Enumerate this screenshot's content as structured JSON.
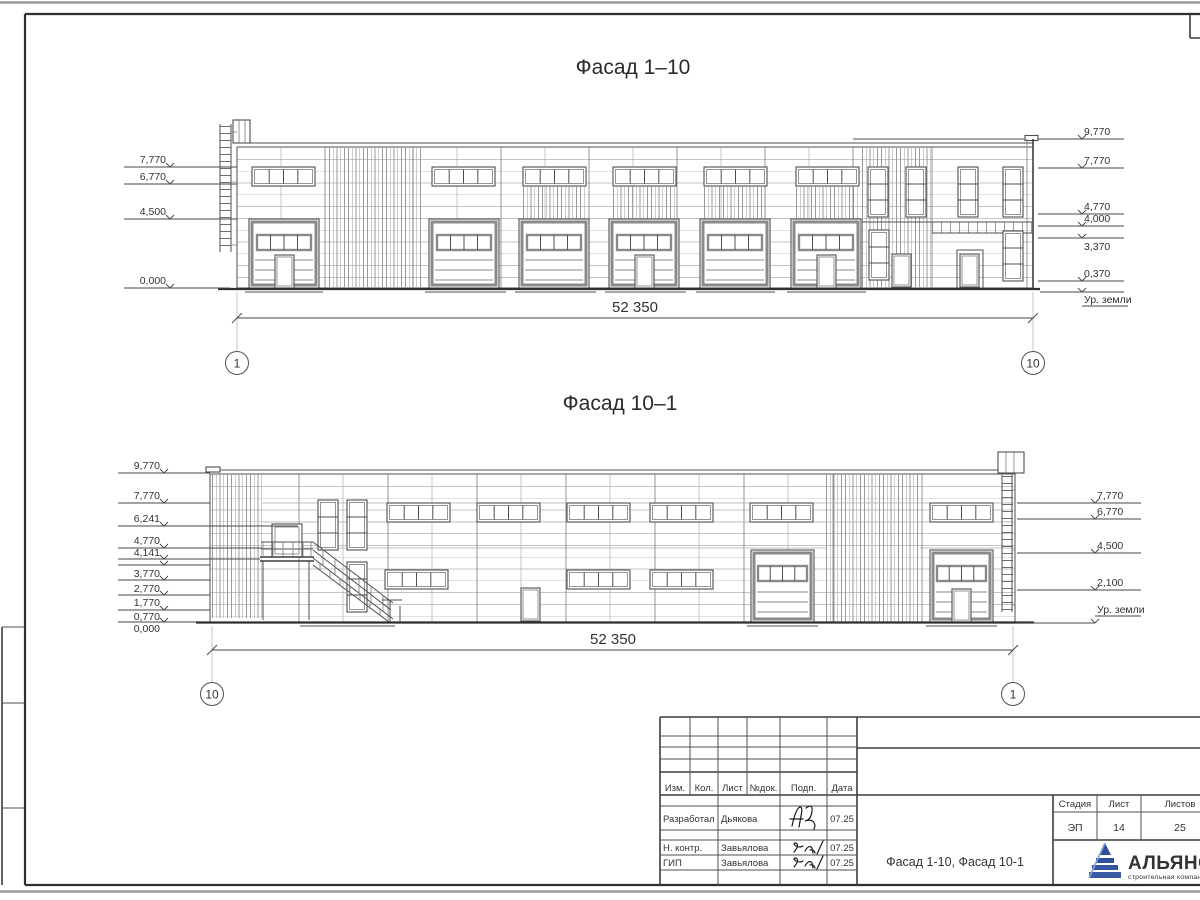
{
  "facade1": {
    "title": "Фасад 1–10",
    "dim": "52 350",
    "axis_left": "1",
    "axis_right": "10",
    "elev_left": [
      "7,770",
      "6,770",
      "4,500",
      "0,000"
    ],
    "elev_right": [
      "9,770",
      "7,770",
      "4,770",
      "4,000",
      "3,370",
      "0,370"
    ],
    "ground": "Ур. земли"
  },
  "facade2": {
    "title": "Фасад 10–1",
    "dim": "52 350",
    "axis_left": "10",
    "axis_right": "1",
    "elev_left": [
      "9,770",
      "7,770",
      "6,241",
      "4,770",
      "4,141",
      "3,770",
      "2,770",
      "1,770",
      "0,770",
      "0,000"
    ],
    "elev_right": [
      "7,770",
      "6,770",
      "4,500",
      "2,100"
    ],
    "ground": "Ур. земли"
  },
  "title_block": {
    "columns": [
      "Изм.",
      "Кол.",
      "Лист",
      "№док.",
      "Подп.",
      "Дата"
    ],
    "rows": [
      {
        "role": "Разработал",
        "name": "Дьякова",
        "date": "07.25"
      },
      {
        "role": "Н. контр.",
        "name": "Завьялова",
        "date": "07.25"
      },
      {
        "role": "ГИП",
        "name": "Завьялова",
        "date": "07.25"
      }
    ],
    "doc_title": "Фасад 1-10, Фасад 10-1",
    "stage_label": "Стадия",
    "sheet_label": "Лист",
    "sheets_label": "Листов",
    "stage": "ЭП",
    "sheet": "14",
    "sheets": "25",
    "company": "АЛЬЯНС",
    "company_sub": "строительная компания"
  },
  "colors": {
    "logo_dark": "#1d3b8c",
    "logo_light": "#3f6ab5",
    "line": "#4f4f4f"
  }
}
